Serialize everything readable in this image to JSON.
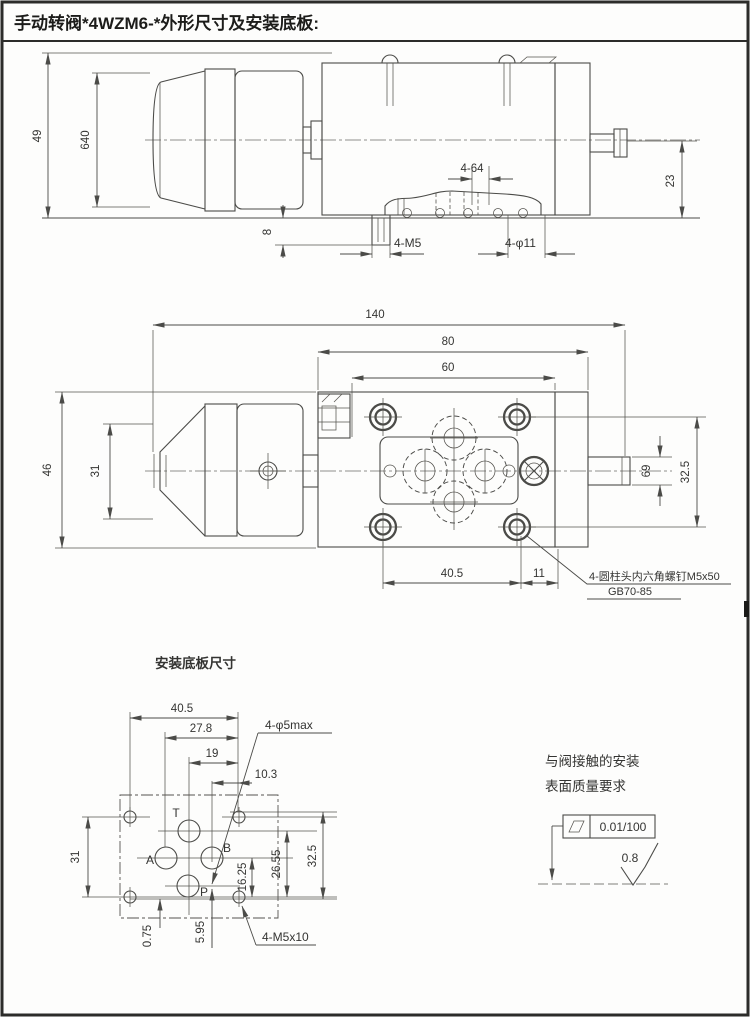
{
  "page": {
    "title": "手动转阀*4WZM6-*外形尺寸及安装底板:"
  },
  "front_view": {
    "dim_height_total": "49",
    "dim_knob_dia": "640",
    "dim_port_height": "23",
    "dim_stud_len": "8",
    "dim_top_holes": "4-64",
    "label_thread_holes": "4-M5",
    "label_through_holes": "4-φ11"
  },
  "plan_view": {
    "dim_length_total": "140",
    "dim_length_80": "80",
    "dim_length_60": "60",
    "dim_width_total": "46",
    "dim_knob_width": "31",
    "dim_side_port": "69",
    "dim_screw_rows": "32.5",
    "dim_screw_span": "40.5",
    "dim_edge_offset": "11",
    "screw_note_line1": "4-圆柱头内六角螺钉M5x50",
    "screw_note_line2": "GB70-85"
  },
  "plate_view": {
    "title": "安装底板尺寸",
    "dim_40_5": "40.5",
    "dim_27_8": "27.8",
    "dim_19": "19",
    "dim_10_3": "10.3",
    "label_port_holes": "4-φ5max",
    "dim_31": "31",
    "dim_0_75": "0.75",
    "dim_5_95": "5.95",
    "dim_16_25": "16.25",
    "dim_26_55": "26.55",
    "dim_32_5": "32.5",
    "label_screw_holes": "4-M5x10",
    "port_t": "T",
    "port_a": "A",
    "port_b": "B",
    "port_p": "P"
  },
  "surface_note": {
    "line1": "与阀接触的安装",
    "line2": "表面质量要求",
    "flatness": "0.01/100",
    "roughness": "0.8"
  },
  "colors": {
    "line": "#4b4b48",
    "text": "#343432",
    "frame": "#2c2c2a"
  }
}
